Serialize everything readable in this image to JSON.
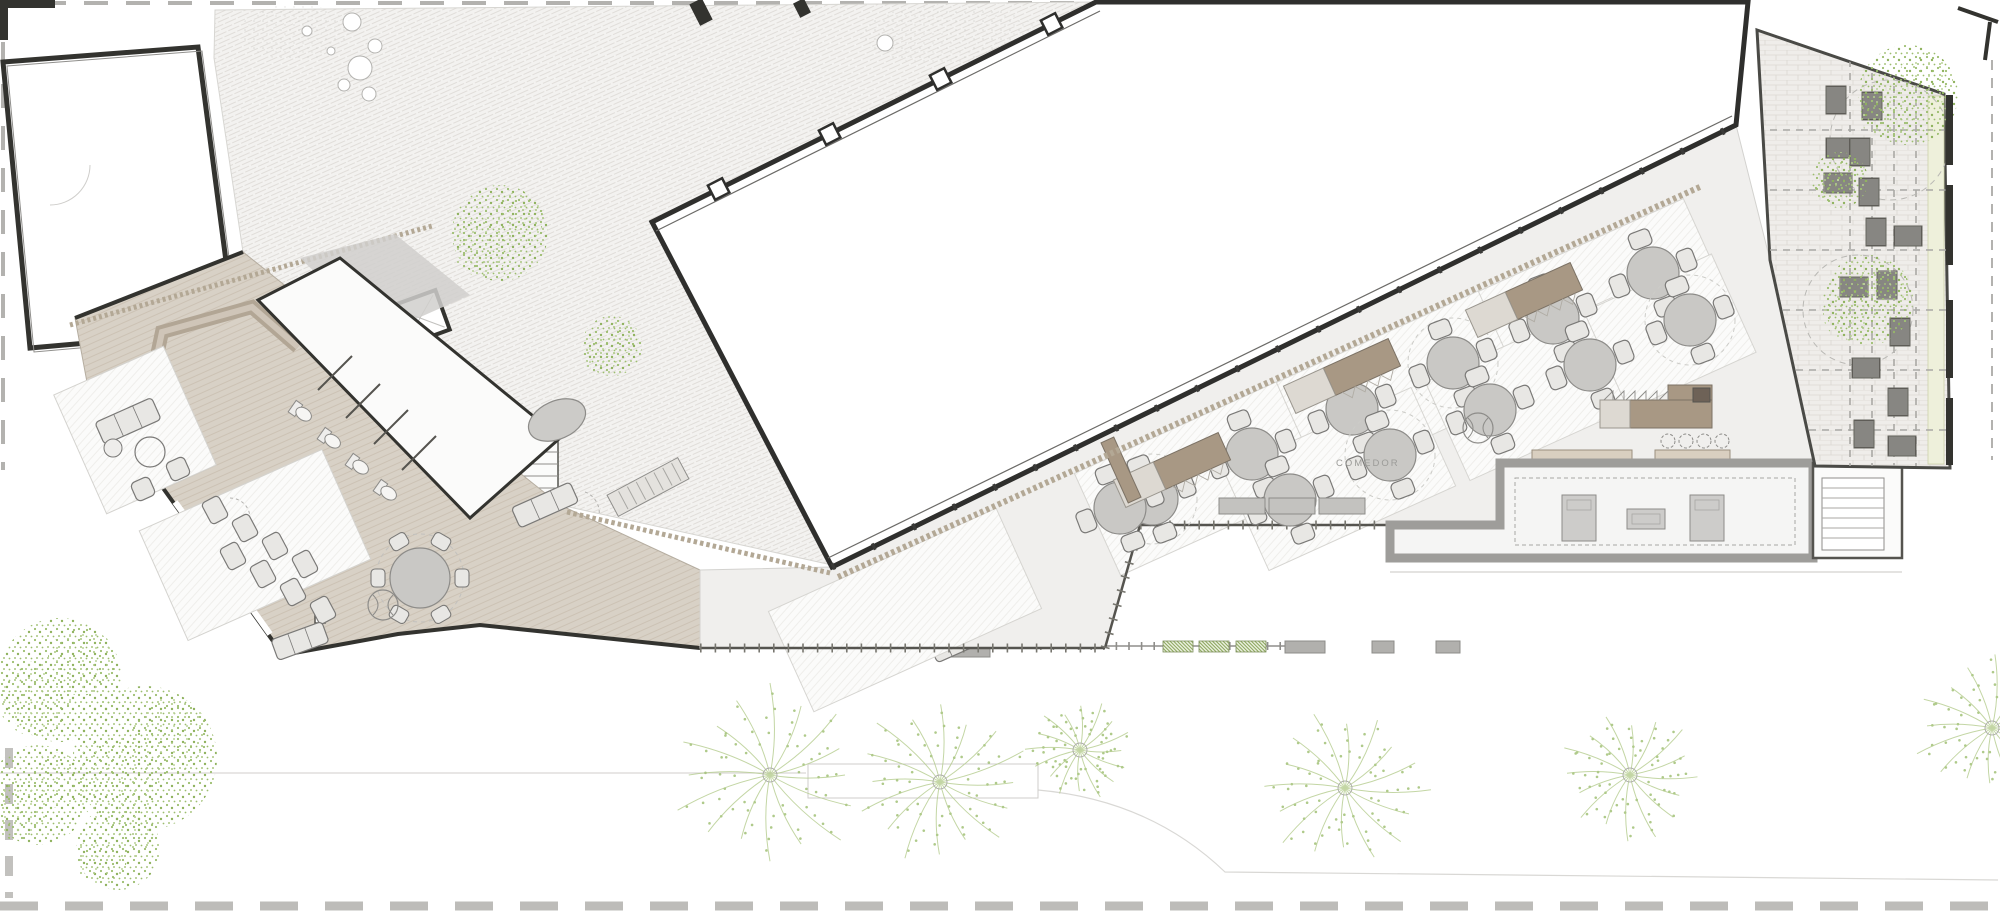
{
  "drawing": {
    "type": "architectural-floor-plan",
    "room_label": "COMEDOR",
    "colors": {
      "paper": "#ffffff",
      "floor": "#f0efed",
      "wood": "#d8d1c6",
      "wood_line": "#c6bcad",
      "wall_dark": "#33332f",
      "wall_gray": "#a8a7a4",
      "tan_dark": "#a89884",
      "tan_light": "#ddd9d2",
      "trim": "#b3a895",
      "furn_fill": "#c9c8c5",
      "furn_stroke": "#8d8c89",
      "chair_fill": "#e8e7e4",
      "chair_stroke": "#7a7977",
      "green": "#9cbd6e",
      "green_dark": "#7d9a4e",
      "kitchen_fill": "#f5f5f4",
      "brick_fill": "#efedea",
      "rug_fill": "#fbfbfa",
      "pale_strip": "#eef0db"
    },
    "dining": {
      "table_radius": 26,
      "chair_angles": [
        21,
        111,
        201,
        291
      ],
      "tables": [
        [
          1152,
          499
        ],
        [
          1252,
          454
        ],
        [
          1352,
          409
        ],
        [
          1453,
          363
        ],
        [
          1553,
          318
        ],
        [
          1653,
          273
        ],
        [
          1120,
          508
        ],
        [
          1290,
          500
        ],
        [
          1390,
          455
        ],
        [
          1490,
          410
        ],
        [
          1590,
          365
        ],
        [
          1690,
          320
        ]
      ],
      "halo_tables": [
        0,
        3,
        8,
        11
      ],
      "rugs": [
        [
          1200,
          478,
          225,
          112
        ],
        [
          1402,
          387,
          225,
          112
        ],
        [
          1604,
          296,
          225,
          112
        ],
        [
          1340,
          479,
          205,
          108
        ],
        [
          1541,
          389,
          205,
          108
        ],
        [
          1670,
          332,
          140,
          108
        ],
        [
          905,
          610,
          250,
          110
        ]
      ],
      "rug_rotation": -24.4,
      "service_stations": [
        [
          1342,
          376
        ],
        [
          1524,
          300
        ],
        [
          1172,
          470
        ]
      ],
      "station_size": [
        30,
        115
      ],
      "planters": [
        [
          912,
          462
        ],
        [
          942,
          456
        ],
        [
          974,
          450
        ]
      ],
      "benches": [
        [
          1242,
          506
        ],
        [
          1292,
          506
        ],
        [
          1342,
          506
        ]
      ],
      "columns": [
        [
          1478,
          428
        ],
        [
          383,
          605
        ]
      ]
    },
    "bar": {
      "counters_diag": [
        [
          1062,
          431,
          115,
          14
        ],
        [
          1121,
          470,
          14,
          66
        ]
      ],
      "appliance_diag": [
        1040,
        414,
        40,
        11
      ],
      "counters_flat": [
        [
          1532,
          450,
          100,
          11
        ],
        [
          1655,
          450,
          75,
          11
        ]
      ],
      "stools": [
        [
          1668,
          441
        ],
        [
          1686,
          441
        ],
        [
          1704,
          441
        ],
        [
          1722,
          441
        ]
      ],
      "buffet": {
        "x": 1600,
        "y": 400,
        "w": 112,
        "h": 28,
        "dark_sq": [
          1693,
          388,
          17,
          14
        ],
        "arm": [
          1668,
          385,
          44,
          15
        ]
      }
    },
    "kitchen": {
      "islands": [
        [
          1562,
          495,
          34,
          46
        ],
        [
          1627,
          509,
          38,
          20
        ],
        [
          1690,
          495,
          34,
          46
        ]
      ]
    },
    "lounge": {
      "chairs": [
        [
          215,
          510
        ],
        [
          245,
          528
        ],
        [
          275,
          546
        ],
        [
          305,
          564
        ],
        [
          233,
          556
        ],
        [
          263,
          574
        ],
        [
          293,
          592
        ],
        [
          323,
          610
        ]
      ],
      "sofas": [
        [
          128,
          421,
          62,
          24,
          -24
        ],
        [
          545,
          505,
          64,
          22,
          -24
        ],
        [
          855,
          600,
          48,
          22,
          -24
        ],
        [
          908,
          622,
          48,
          22,
          -24
        ],
        [
          955,
          643,
          48,
          22,
          -24
        ],
        [
          300,
          641,
          54,
          22,
          -20
        ]
      ],
      "armchairs": [
        [
          178,
          469
        ],
        [
          143,
          489
        ],
        [
          998,
          600
        ],
        [
          1018,
          620
        ],
        [
          925,
          585
        ]
      ],
      "poufs": [
        [
          113,
          448
        ],
        [
          875,
          640
        ]
      ],
      "round_table": [
        150,
        452,
        15
      ],
      "tip_table": [
        420,
        578,
        30
      ],
      "oval_table": [
        557,
        420,
        30,
        19
      ],
      "toilets": [
        [
          302,
          413
        ],
        [
          331,
          440
        ],
        [
          359,
          466
        ],
        [
          387,
          492
        ]
      ]
    },
    "terrace": {
      "loungers": [
        [
          1836,
          100,
          0
        ],
        [
          1872,
          106,
          0
        ],
        [
          1840,
          148,
          90
        ],
        [
          1860,
          152,
          0
        ],
        [
          1838,
          183,
          90
        ],
        [
          1869,
          192,
          0
        ],
        [
          1876,
          232,
          0
        ],
        [
          1908,
          236,
          90
        ],
        [
          1887,
          285,
          0
        ],
        [
          1854,
          287,
          90
        ],
        [
          1900,
          332,
          0
        ],
        [
          1866,
          368,
          90
        ],
        [
          1898,
          402,
          0
        ],
        [
          1864,
          434,
          0
        ],
        [
          1902,
          446,
          90
        ]
      ],
      "lounger_size": [
        20,
        28
      ],
      "pergola_verticals": [
        1850,
        1872,
        1894,
        1916
      ],
      "pergola_horizontals": [
        130,
        190,
        250,
        310,
        370,
        430
      ],
      "canopy_outlines": [
        [
          1890,
          140,
          60
        ],
        [
          1858,
          310,
          55
        ]
      ],
      "wall_bars": [
        [
          95,
          165
        ],
        [
          185,
          265
        ],
        [
          300,
          378
        ],
        [
          398,
          465
        ]
      ]
    },
    "vegetation": {
      "palms": [
        [
          770,
          775,
          100
        ],
        [
          940,
          782,
          90
        ],
        [
          1080,
          750,
          55
        ],
        [
          1345,
          788,
          86
        ],
        [
          1630,
          775,
          72
        ],
        [
          1992,
          728,
          80
        ]
      ],
      "street_trees": [
        [
          60,
          680,
          62
        ],
        [
          145,
          758,
          72
        ],
        [
          38,
          795,
          50
        ],
        [
          118,
          848,
          42
        ]
      ],
      "courtyard_trees": [
        [
          500,
          233,
          48
        ],
        [
          612,
          346,
          30
        ]
      ],
      "terrace_trees": [
        [
          1908,
          95,
          50
        ],
        [
          1840,
          180,
          28
        ],
        [
          1868,
          300,
          45
        ]
      ]
    },
    "courtyard": {
      "white_circles": [
        [
          352,
          22,
          9
        ],
        [
          375,
          46,
          7
        ],
        [
          360,
          68,
          12
        ],
        [
          344,
          85,
          6
        ],
        [
          369,
          94,
          7
        ],
        [
          307,
          31,
          5
        ],
        [
          331,
          51,
          4
        ],
        [
          885,
          43,
          8
        ]
      ]
    },
    "street": {
      "green_hedges": [
        [
          1163,
          641
        ],
        [
          1199,
          641
        ],
        [
          1236,
          641
        ]
      ],
      "gray_benches": [
        [
          820,
          645,
          170,
          12
        ],
        [
          1285,
          641,
          40,
          12
        ],
        [
          1372,
          641,
          22,
          12
        ],
        [
          1436,
          641,
          24,
          12
        ]
      ]
    }
  }
}
